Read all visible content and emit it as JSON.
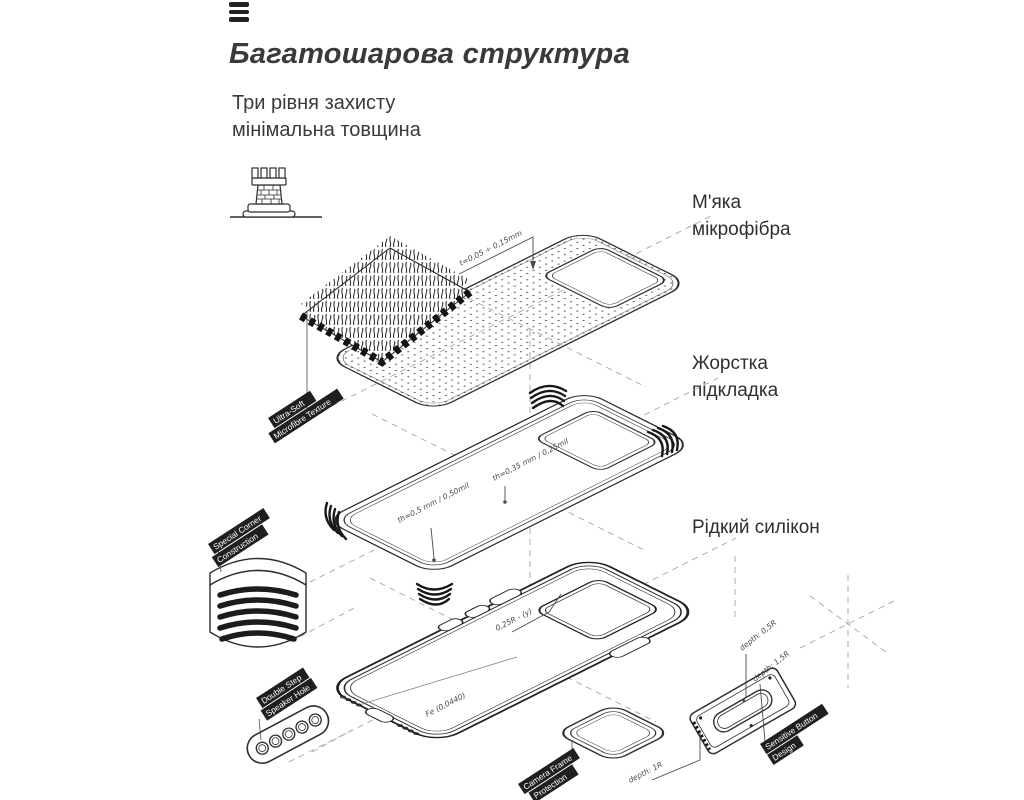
{
  "page": {
    "title": "Багатошарова структура",
    "subtitle_line1": "Три рівня захисту",
    "subtitle_line2": "мінімальна товщина"
  },
  "icons": {
    "menu": "hamburger-menu",
    "protection": "castle-tower"
  },
  "layer_labels": [
    {
      "text": "М'яка мікрофібра"
    },
    {
      "text": "Жорстка підкладка"
    },
    {
      "text": "Рідкий силікон"
    }
  ],
  "annotations": {
    "microfiber_thickness": "t=0,05 ÷ 0,15mm",
    "shell_thickness_top": "th=0,35 mm / 0,25mil",
    "shell_thickness_side": "th=0,5 mm / 0,50mil",
    "case_edge_radius": "0,25R - (y)",
    "case_bottom": "Fe (0,0440)",
    "button_depth_outer": "depth: 0,5R",
    "button_depth_inner": "depth: 1,5R",
    "camera_depth": "depth: 1R"
  },
  "feature_tags": [
    {
      "lines": [
        "Ultra-Soft",
        "Microfibre Texture"
      ]
    },
    {
      "lines": [
        "Special Corner",
        "Construction"
      ]
    },
    {
      "lines": [
        "Double Step",
        "Speaker Hole"
      ]
    },
    {
      "lines": [
        "Camera Frame",
        "Protection"
      ]
    },
    {
      "lines": [
        "Sensitive Button",
        "Design"
      ]
    }
  ],
  "colors": {
    "ink": "#2e2e2e",
    "text": "#3a3a3a",
    "tag_bg": "#1f1f1f",
    "tag_text": "#ffffff",
    "dashed": "#a5a5a5"
  }
}
